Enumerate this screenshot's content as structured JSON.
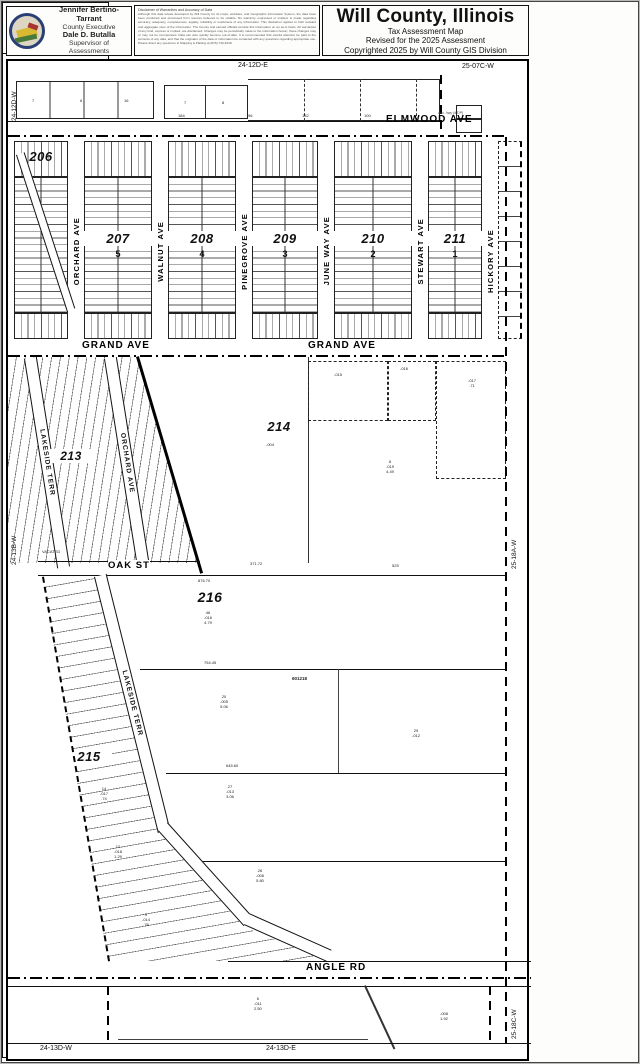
{
  "header": {
    "official1": "Jennifer Bertino-Tarrant",
    "title1": "County Executive",
    "official2": "Dale D. Butalla",
    "title2": "Supervisor of Assessments",
    "disclaimer_title": "Disclaimer of Warranties and Accuracy of Data",
    "disclaimer_body": "Although this data is/was developed by Will County for its maps, websites, and Geographic Information System, the data have been produced and processed from sources believed to be reliable. No warranty, expressed or implied, is made regarding accuracy, adequacy, completeness, legality, reliability or usefulness of any information. This disclaimer applies to both isolated and aggregate uses of the information. The County and elected officials provide this information on an as-is basis. All warranties of any kind, express or implied, are disclaimed. Changes may be periodically made to the information herein; these changes may or may not be incorporated. Data can also quickly become out-of-date. It is recommended that careful attention be paid to the contents of any data, and that the originator of the data or information be contacted with any questions regarding appropriate use. Please direct any questions to Mapping & Platting at (815) 740-4648.",
    "title_block": {
      "title": "Will County, Illinois",
      "line1": "Tax Assessment Map",
      "line2": "Revised for the 2025 Assessment",
      "line3": "Copyrighted 2025 by Will County GIS Division"
    },
    "map_page": {
      "label": "Map Page  24-13B-E",
      "township": "Wesley Township",
      "section": "E 1/2 N.E.1/4 Sec.13 T.32N. R.9E."
    }
  },
  "sidebar": {
    "title": "Subdivision List",
    "items": [
      {
        "code": "S005820",
        "name": "County Clerk's Sub",
        "ref": "601218 (26-50)"
      },
      {
        "code": "S005917",
        "name": "Rest Haven Beach",
        "ref": "411074 (17-68)"
      },
      {
        "code": "S005920",
        "name": "River Oak Sub",
        "ref": "23-16"
      }
    ],
    "scale": "1 inch = 200 feet",
    "plot_date": "Plot Date: Jul 08 2025"
  },
  "map": {
    "edge_labels": {
      "top_left_v": "24-12D-W",
      "top_center": "24-12D-E",
      "top_right": "25-07C-W",
      "left_mid_v": "24-13B-W",
      "right_mid_v": "25-18A-W",
      "right_bottom_v": "25-18C-W",
      "bottom_left": "24-13D-W",
      "bottom_center": "24-13D-E"
    },
    "streets": {
      "elmwood": "ELMWOOD AVE",
      "grand_w": "GRAND AVE",
      "grand_e": "GRAND AVE",
      "oak": "OAK ST",
      "angle": "ANGLE RD",
      "orchard_n": "ORCHARD AVE",
      "walnut": "WALNUT AVE",
      "pinegrove": "PINEGROVE AVE",
      "june_way": "JUNE WAY AVE",
      "stewart": "STEWART AVE",
      "hickory": "HICKORY AVE",
      "lakeside_mid": "LAKESIDE TERR",
      "orchard_mid": "ORCHARD AVE",
      "lakeside_s": "LAKESIDE TERR"
    },
    "blocks": {
      "b206": "206",
      "b207": "207",
      "b207_sub": "5",
      "b208": "208",
      "b208_sub": "4",
      "b209": "209",
      "b209_sub": "3",
      "b210": "210",
      "b210_sub": "2",
      "b211": "211",
      "b211_sub": "1",
      "b213": "213",
      "b214": "214",
      "b215": "215",
      "b216": "216"
    },
    "annotations": [
      {
        "t": "184",
        "x": 170,
        "y": 53
      },
      {
        "t": "96",
        "x": 240,
        "y": 53
      },
      {
        "t": "132",
        "x": 294,
        "y": 53
      },
      {
        "t": "100",
        "x": 356,
        "y": 53
      },
      {
        "t": "aux. hwy (#T/P)",
        "x": 430,
        "y": 50,
        "c": "i"
      },
      {
        "t": "7",
        "x": 24,
        "y": 38
      },
      {
        "t": "6",
        "x": 72,
        "y": 38
      },
      {
        "t": "16",
        "x": 116,
        "y": 38
      },
      {
        "t": "7",
        "x": 176,
        "y": 40
      },
      {
        "t": "8",
        "x": 214,
        "y": 40
      },
      {
        "t": "371.72",
        "x": 242,
        "y": 501
      },
      {
        "t": "876.70",
        "x": 190,
        "y": 518
      },
      {
        "t": "525",
        "x": 384,
        "y": 503
      },
      {
        "t": "754.45",
        "x": 196,
        "y": 600
      },
      {
        "t": "645.60",
        "x": 218,
        "y": 703
      },
      {
        "t": "601218",
        "x": 284,
        "y": 615,
        "c": "b"
      },
      {
        "t": "VACATED",
        "x": 34,
        "y": 489
      },
      {
        "lines": [
          "-004"
        ],
        "x": 258,
        "y": 382
      },
      {
        "lines": [
          "8",
          "-019",
          "4.49"
        ],
        "x": 378,
        "y": 399
      },
      {
        "lines": [
          "-015"
        ],
        "x": 326,
        "y": 312
      },
      {
        "lines": [
          "-016"
        ],
        "x": 392,
        "y": 306
      },
      {
        "lines": [
          "-017",
          ".71"
        ],
        "x": 460,
        "y": 318
      },
      {
        "lines": [
          "46",
          "-016",
          "4.79"
        ],
        "x": 196,
        "y": 550
      },
      {
        "lines": [
          "20",
          "-005",
          "5.06"
        ],
        "x": 212,
        "y": 634
      },
      {
        "lines": [
          "29",
          "-012"
        ],
        "x": 404,
        "y": 668
      },
      {
        "lines": [
          "27",
          "-013",
          "3.06"
        ],
        "x": 218,
        "y": 724
      },
      {
        "lines": [
          "26",
          "-006",
          "5.80"
        ],
        "x": 248,
        "y": 808
      },
      {
        "lines": [
          "14",
          "-017",
          ".74"
        ],
        "x": 92,
        "y": 726
      },
      {
        "lines": [
          "12",
          "-018",
          "1.29"
        ],
        "x": 106,
        "y": 784
      },
      {
        "lines": [
          "9",
          "-014",
          ".78"
        ],
        "x": 134,
        "y": 852
      },
      {
        "lines": [
          "6",
          "-011",
          "2.50"
        ],
        "x": 246,
        "y": 936
      },
      {
        "lines": [
          "-008",
          "1.92"
        ],
        "x": 432,
        "y": 951
      }
    ]
  }
}
